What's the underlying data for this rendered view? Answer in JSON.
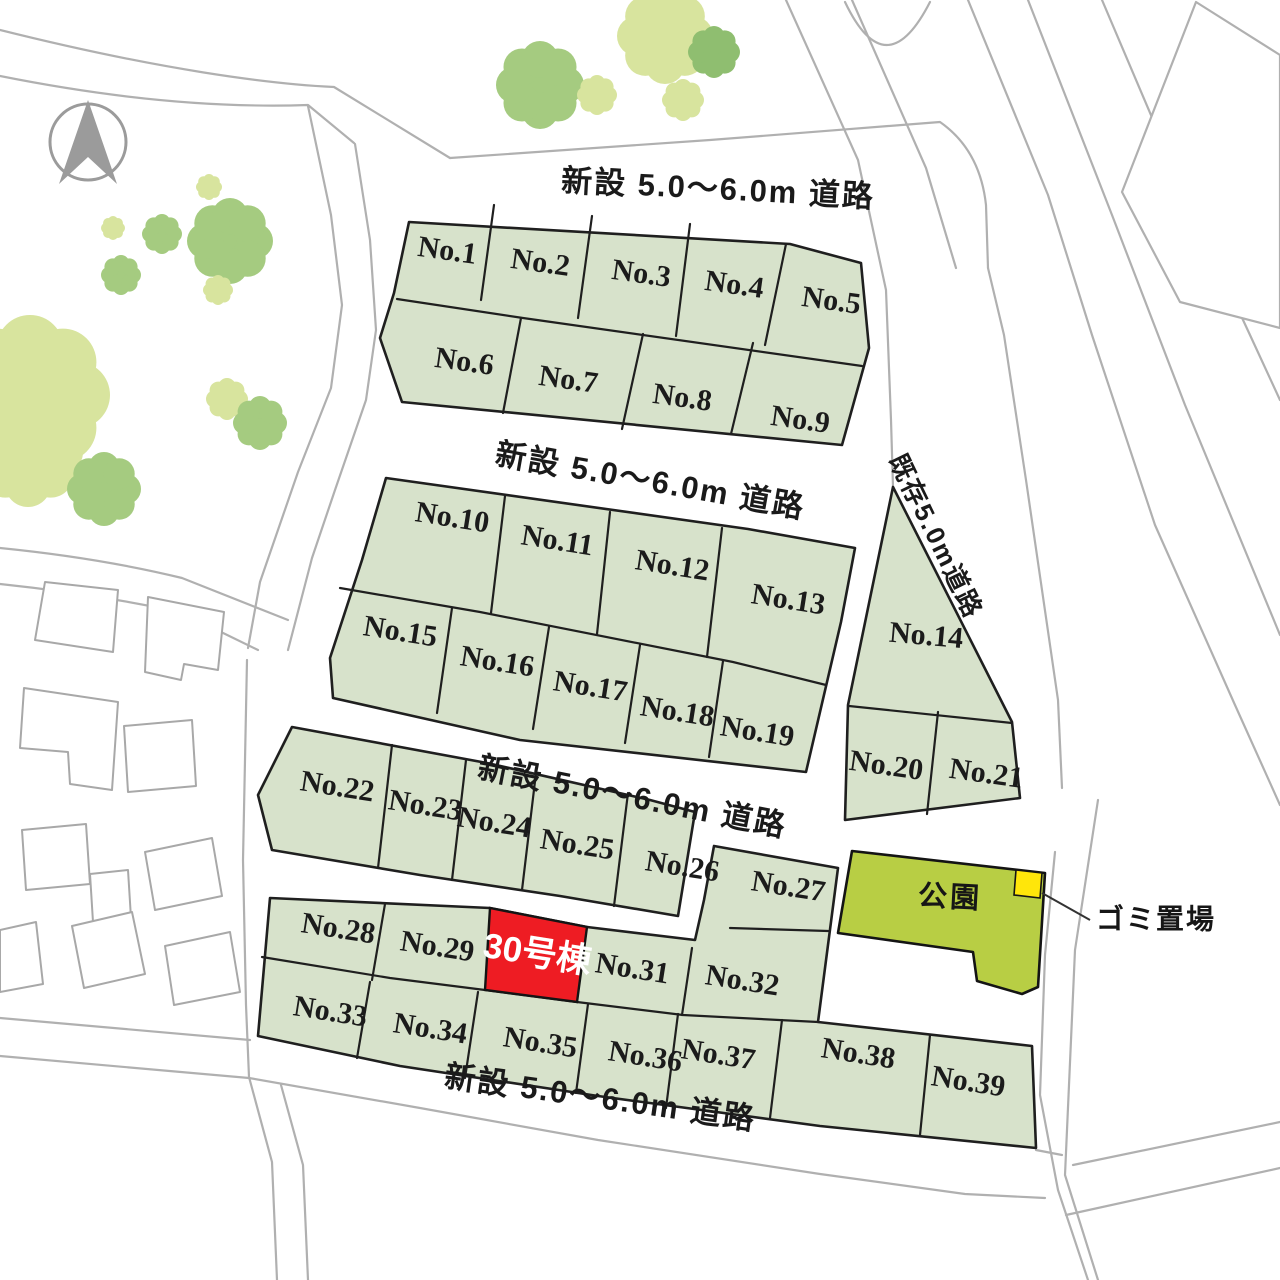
{
  "map": {
    "type": "residential-subdivision-plot-map",
    "compass": {
      "name": "north-arrow"
    },
    "road_labels": [
      {
        "id": "road-label-top",
        "text": "新設 5.0〜6.0m 道路",
        "x": 718,
        "y": 191,
        "rot": 3,
        "size": 31
      },
      {
        "id": "road-label-middle",
        "text": "新設 5.0〜6.0m 道路",
        "x": 650,
        "y": 483,
        "rot": 10,
        "size": 31
      },
      {
        "id": "road-label-lower",
        "text": "新設 5.0〜6.0m 道路",
        "x": 632,
        "y": 799,
        "rot": 11,
        "size": 31
      },
      {
        "id": "road-label-bottom",
        "text": "新設 5.0〜6.0m 道路",
        "x": 600,
        "y": 1100,
        "rot": 8,
        "size": 31
      },
      {
        "id": "road-label-existing",
        "text": "既存5.0m道路",
        "x": 934,
        "y": 537,
        "rot": 64,
        "size": 26
      }
    ],
    "lots": [
      {
        "no": "No.1",
        "x": 447,
        "y": 253,
        "rot": 8
      },
      {
        "no": "No.2",
        "x": 540,
        "y": 265,
        "rot": 8
      },
      {
        "no": "No.3",
        "x": 641,
        "y": 276,
        "rot": 8
      },
      {
        "no": "No.4",
        "x": 734,
        "y": 287,
        "rot": 8
      },
      {
        "no": "No.5",
        "x": 831,
        "y": 303,
        "rot": 8
      },
      {
        "no": "No.6",
        "x": 464,
        "y": 364,
        "rot": 8
      },
      {
        "no": "No.7",
        "x": 568,
        "y": 382,
        "rot": 8
      },
      {
        "no": "No.8",
        "x": 682,
        "y": 400,
        "rot": 8
      },
      {
        "no": "No.9",
        "x": 800,
        "y": 422,
        "rot": 8
      },
      {
        "no": "No.10",
        "x": 452,
        "y": 520,
        "rot": 9
      },
      {
        "no": "No.11",
        "x": 557,
        "y": 543,
        "rot": 9
      },
      {
        "no": "No.12",
        "x": 672,
        "y": 568,
        "rot": 9
      },
      {
        "no": "No.13",
        "x": 788,
        "y": 602,
        "rot": 9
      },
      {
        "no": "No.14",
        "x": 926,
        "y": 638,
        "rot": 5
      },
      {
        "no": "No.15",
        "x": 400,
        "y": 634,
        "rot": 9
      },
      {
        "no": "No.16",
        "x": 497,
        "y": 664,
        "rot": 9
      },
      {
        "no": "No.17",
        "x": 590,
        "y": 689,
        "rot": 9
      },
      {
        "no": "No.18",
        "x": 677,
        "y": 714,
        "rot": 9
      },
      {
        "no": "No.19",
        "x": 757,
        "y": 734,
        "rot": 9
      },
      {
        "no": "No.20",
        "x": 886,
        "y": 768,
        "rot": 8
      },
      {
        "no": "No.21",
        "x": 986,
        "y": 776,
        "rot": 8
      },
      {
        "no": "No.22",
        "x": 337,
        "y": 789,
        "rot": 9
      },
      {
        "no": "No.23",
        "x": 425,
        "y": 808,
        "rot": 9
      },
      {
        "no": "No.24",
        "x": 494,
        "y": 825,
        "rot": 9
      },
      {
        "no": "No.25",
        "x": 577,
        "y": 847,
        "rot": 9
      },
      {
        "no": "No.26",
        "x": 682,
        "y": 869,
        "rot": 9
      },
      {
        "no": "No.27",
        "x": 788,
        "y": 889,
        "rot": 9
      },
      {
        "no": "No.28",
        "x": 338,
        "y": 931,
        "rot": 9
      },
      {
        "no": "No.29",
        "x": 437,
        "y": 949,
        "rot": 9
      },
      {
        "no": "No.31",
        "x": 632,
        "y": 971,
        "rot": 9
      },
      {
        "no": "No.32",
        "x": 742,
        "y": 983,
        "rot": 9
      },
      {
        "no": "No.33",
        "x": 330,
        "y": 1014,
        "rot": 9
      },
      {
        "no": "No.34",
        "x": 430,
        "y": 1031,
        "rot": 9
      },
      {
        "no": "No.35",
        "x": 540,
        "y": 1045,
        "rot": 9
      },
      {
        "no": "No.36",
        "x": 645,
        "y": 1059,
        "rot": 9
      },
      {
        "no": "No.37",
        "x": 718,
        "y": 1057,
        "rot": 9
      },
      {
        "no": "No.38",
        "x": 858,
        "y": 1056,
        "rot": 9
      },
      {
        "no": "No.39",
        "x": 968,
        "y": 1084,
        "rot": 9
      }
    ],
    "featured_lot": {
      "label": "30号棟",
      "x": 537,
      "y": 956,
      "rot": 9,
      "size": 35
    },
    "park": {
      "label": "公園",
      "x": 950,
      "y": 899,
      "rot": 3,
      "size": 29
    },
    "garbage": {
      "label": "ゴミ置場",
      "x": 1096,
      "y": 921,
      "size": 28
    },
    "colors": {
      "lot_fill": "#d7e2cb",
      "lot_stroke": "#1f1f1f",
      "featured": "#ee1c23",
      "park": "#b8ce44",
      "garbage": "#ffe60a",
      "road_line": "#b0b0b0",
      "house_stroke": "#a8a8a8",
      "compass": "#9b9b9b",
      "label": "#1b1b1b",
      "tree_green": "#a5cb80",
      "tree_light": "#d8e49e",
      "tree_dark": "#8fbe70"
    }
  }
}
